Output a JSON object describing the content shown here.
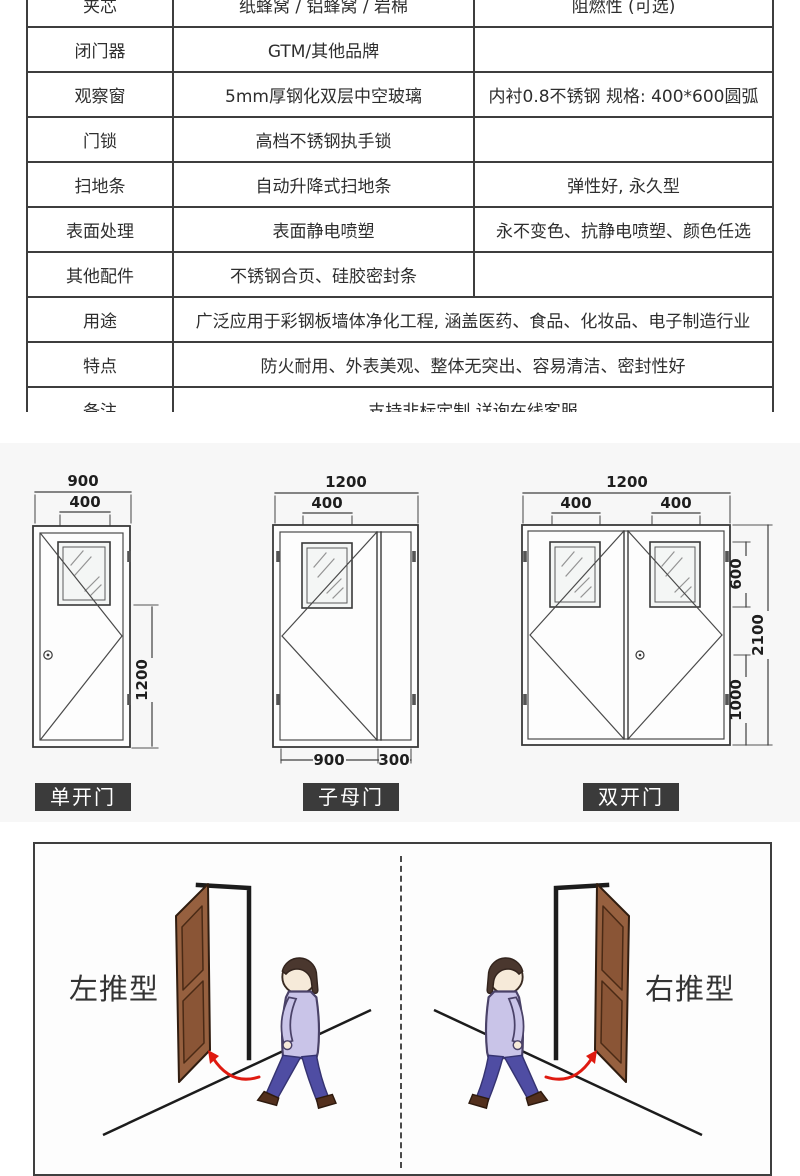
{
  "spec_table": {
    "rows": [
      {
        "label": "夹芯",
        "col2": "纸蜂窝 / 铝蜂窝 / 岩棉",
        "col3": "阻燃性 (可选)",
        "span": false
      },
      {
        "label": "闭门器",
        "col2": "GTM/其他品牌",
        "col3": "",
        "span": false
      },
      {
        "label": "观察窗",
        "col2": "5mm厚钢化双层中空玻璃",
        "col3": "内衬0.8不锈钢 规格: 400*600圆弧",
        "span": false
      },
      {
        "label": "门锁",
        "col2": "高档不锈钢执手锁",
        "col3": "",
        "span": false
      },
      {
        "label": "扫地条",
        "col2": "自动升降式扫地条",
        "col3": "弹性好, 永久型",
        "span": false
      },
      {
        "label": "表面处理",
        "col2": "表面静电喷塑",
        "col3": "永不变色、抗静电喷塑、颜色任选",
        "span": false
      },
      {
        "label": "其他配件",
        "col2": "不锈钢合页、硅胶密封条",
        "col3": "",
        "span": false
      },
      {
        "label": "用途",
        "col2": "广泛应用于彩钢板墙体净化工程, 涵盖医药、食品、化妆品、电子制造行业",
        "span": true
      },
      {
        "label": "特点",
        "col2": "防火耐用、外表美观、整体无突出、容易清洁、密封性好",
        "span": true
      },
      {
        "label": "备注",
        "col2": "支持非标定制 详询在线客服",
        "span": true
      }
    ]
  },
  "diagrams": {
    "single_door": {
      "label": "单开门",
      "overall_width": "900",
      "window_width": "400",
      "height_dim": "1200"
    },
    "mother_child_door": {
      "label": "子母门",
      "overall_width": "1200",
      "window_width": "400",
      "main_leaf_width": "900",
      "small_leaf_width": "300"
    },
    "double_door": {
      "label": "双开门",
      "overall_width": "1200",
      "left_window_width": "400",
      "right_window_width": "400",
      "window_height": "600",
      "total_height": "2100",
      "lower_height": "1000"
    }
  },
  "swing_types": {
    "left_label": "左推型",
    "right_label": "右推型"
  },
  "colors": {
    "table_border": "#3d3d3d",
    "badge_bg": "#3b3b3b",
    "panel_bg": "#f7f7f7",
    "door_brown": "#96603f",
    "door_panel_brown": "#8a5536",
    "shirt_lavender": "#c9c4e8",
    "pants_blue": "#4f4da3",
    "arrow_red": "#df1a10"
  }
}
